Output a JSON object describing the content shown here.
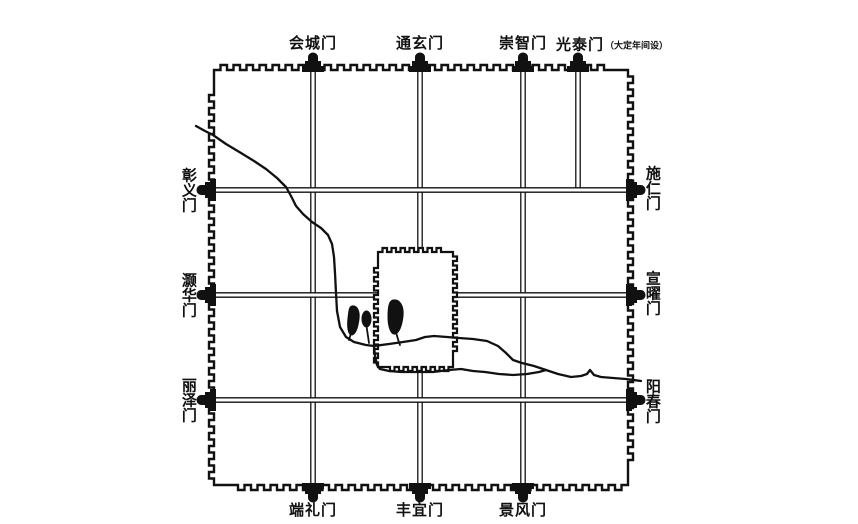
{
  "colors": {
    "background": "#ffffff",
    "ink": "#111111"
  },
  "gates": {
    "top": [
      {
        "label": "会城门"
      },
      {
        "label": "通玄门"
      },
      {
        "label": "崇智门"
      },
      {
        "label": "光泰门",
        "note": "（大定年间设）"
      }
    ],
    "right": [
      {
        "label": "施仁门"
      },
      {
        "label": "宣曜门"
      },
      {
        "label": "阳春门"
      }
    ],
    "bottom": [
      {
        "label": "端礼门"
      },
      {
        "label": "丰宜门"
      },
      {
        "label": "景风门"
      }
    ],
    "left": [
      {
        "label": "彰义门"
      },
      {
        "label": "灏华门"
      },
      {
        "label": "丽泽门"
      }
    ]
  }
}
